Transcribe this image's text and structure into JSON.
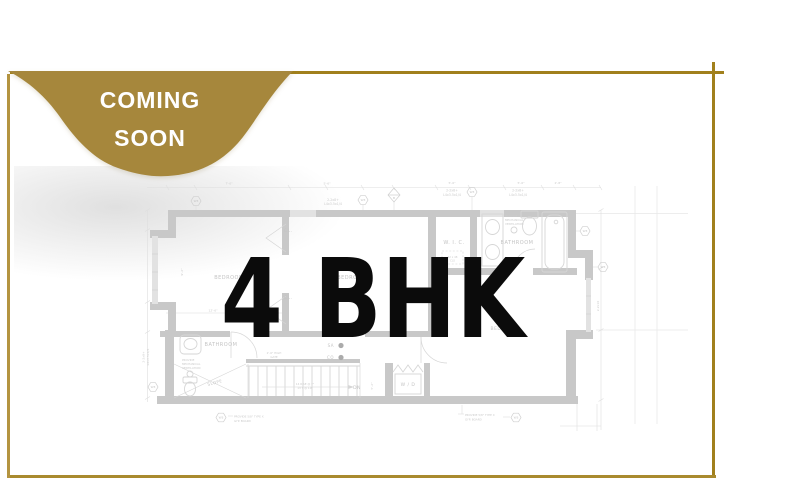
{
  "badge": {
    "line1": "COMING",
    "line2": "SOON"
  },
  "headline": "4 BHK",
  "colors": {
    "frame_gold": "#a1801c",
    "frame_gold_light": "#b49440",
    "badge_gold": "#a6873c",
    "badge_text": "#ffffff",
    "headline_text": "#0b0b0b",
    "plan_wall_gray": "#c8c8c8",
    "plan_line_gray": "#d9d9d9",
    "plan_text_gray": "#c4c4c4"
  },
  "floor_plan": {
    "room_labels": {
      "bedroom_left": "BEDROOM",
      "bedroom_mid": "BEDROOM",
      "bedroom_right": "BEDROOM",
      "closet_upper": "CL.",
      "closet_lower": "CL.",
      "wic": "W. I. C.",
      "bathroom_upper": "BATHROOM",
      "bathroom_lower": "BATHROOM",
      "washer_dryer": "W / D",
      "slope": "SLOPE",
      "down": "DN"
    },
    "annotations": {
      "smoke_alarm": "SA",
      "carbon_monoxide": "CO",
      "wall_tag": "W3",
      "beam_tag": "B",
      "vent_note_1": "PROVIDE",
      "vent_note_2": "MECHANICAL",
      "vent_note_3": "VENTILATION",
      "gyp_note_1": "PROVIDE 5/8\" TYPE X",
      "gyp_note_2": "GYP. BOARD",
      "gate_note_1": "2'-6\" HIGH",
      "gate_note_2": "GATE",
      "stair_note_1": "14 RISE @ 7\"",
      "stair_note_2": "13 T @ 10\"",
      "beam_note_1": "2-2x8+",
      "beam_note_2": "L4x3.5x1/4",
      "beam_note_right": "2-2x10",
      "closet_dim_1": "22 x 48",
      "closet_dim_2": "CLS"
    },
    "dimensions": {
      "d1": "5'-6\"",
      "d2": "7'-0\"",
      "d3": "2'-8\"",
      "d4": "7'-6\"",
      "d5": "12'-6\"",
      "d6": "9'-2\"",
      "d7": "5'-2\""
    }
  }
}
